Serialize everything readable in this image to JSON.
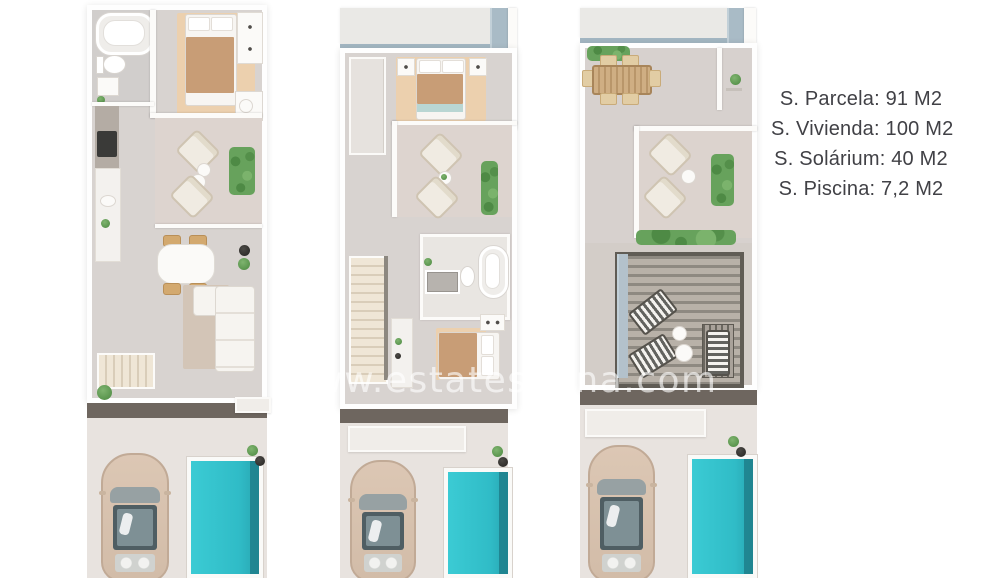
{
  "specs": {
    "lines": [
      "S. Parcela: 91 M2",
      "S. Vivienda: 100 M2",
      "S. Solárium: 40 M2",
      "S. Piscina: 7,2 M2"
    ]
  },
  "watermark": {
    "text": "www.estatespana.com"
  },
  "colors": {
    "background": "#ffffff",
    "spec_text": "#414146",
    "watermark_text": "rgba(255,255,255,0.62)",
    "interior_floor": "#d8d3d0",
    "terrace_floor": "#ddd4cf",
    "bedroom_rug": "#ecd0ae",
    "bed_blanket": "#c89d76",
    "kitchen_counter": "#b4aca4",
    "hedge_green": "#67a25c",
    "pool_water": "#35c4ce",
    "pool_shadow": "#1f7f8b",
    "driveway": "#e8e3df",
    "facade_band": "#6e665f",
    "roof_band": "#eae9e6",
    "roof_edge_blue": "#a9bbc6",
    "car_body": "#d9c3b0",
    "stairs": "#eadfce"
  }
}
